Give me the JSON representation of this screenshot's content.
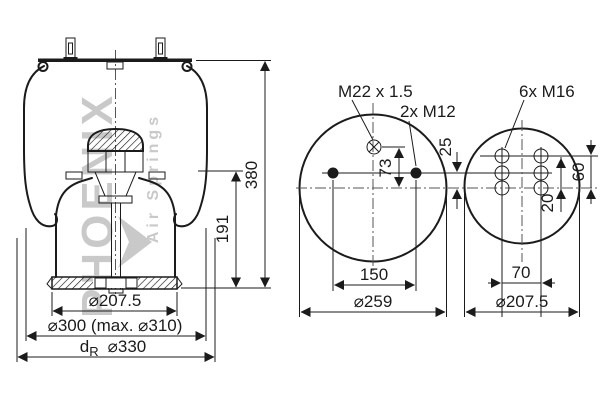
{
  "drawing": {
    "watermark": {
      "brand": "PHOENIX",
      "tagline": "Air Springs"
    },
    "side_view": {
      "dim_height_total": "380",
      "dim_height_piston": "191",
      "dim_piston_dia": "⌀207.5",
      "dim_bellows_dia": "⌀300 (max. ⌀310)",
      "dim_roll_prefix": "d",
      "dim_roll_sub": "R",
      "dim_roll_dia": "⌀330"
    },
    "top_view": {
      "label_air_fitting": "M22 x 1.5",
      "label_studs": "2x M12",
      "dim_fitting_offset": "73",
      "dim_stud_offset": "25",
      "dim_stud_spacing": "150",
      "dim_plate_dia": "⌀259"
    },
    "bottom_view": {
      "label_bolts": "6x M16",
      "dim_rows_span": "60",
      "dim_row_offset": "20",
      "dim_col_spacing": "70",
      "dim_piston_dia": "⌀207.5"
    }
  }
}
